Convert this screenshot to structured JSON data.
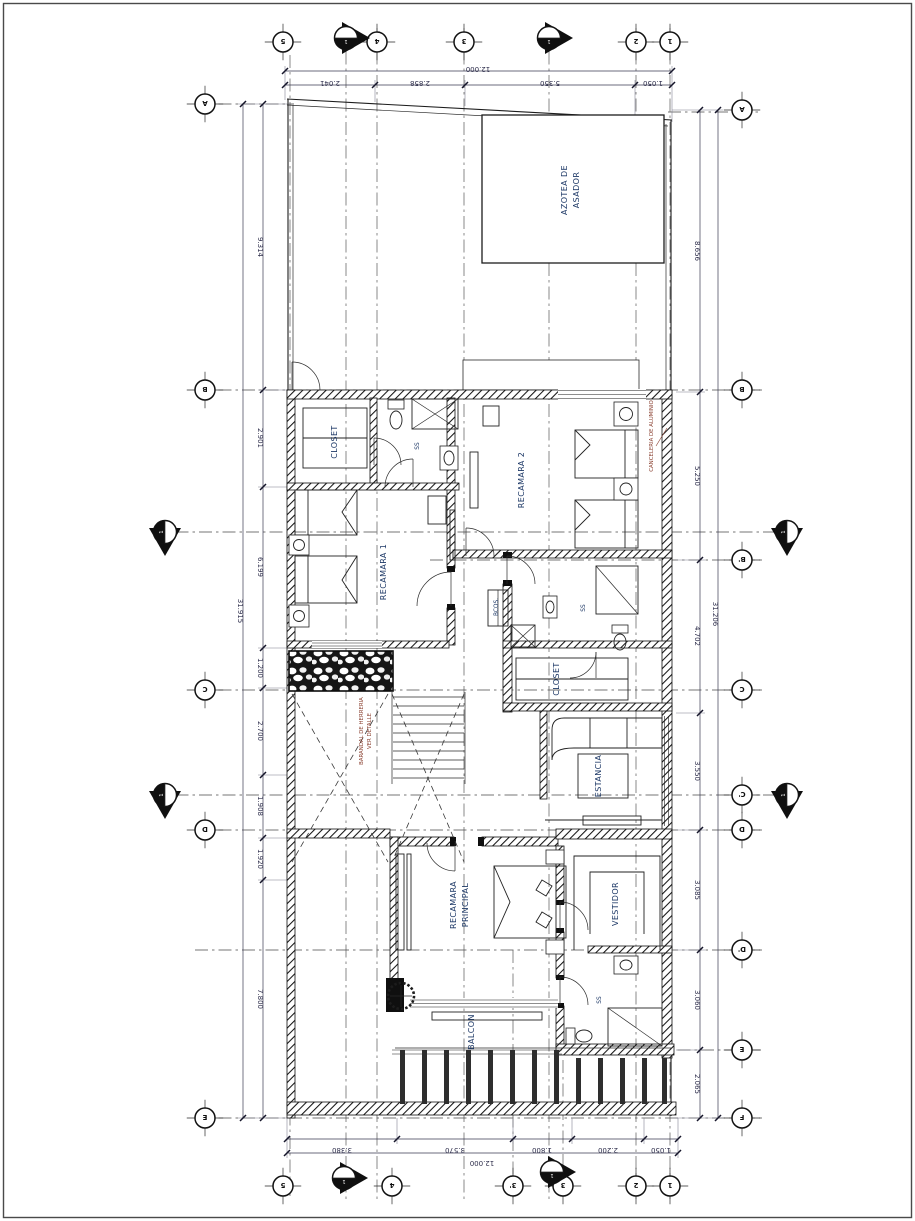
{
  "page": {
    "type_note": "architectural floor plan sheet (planta alta), rotated on page",
    "line_color": "#1c1c1c",
    "label_color": "#1d3866",
    "annotation_color": "#8a4030",
    "background": "#ffffff"
  },
  "rooms": {
    "azotea_line1": "AZOTEA DE",
    "azotea_line2": "ASADOR",
    "recamara2": "RECAMARA 2",
    "closet_recamara1": "CLOSET",
    "bath_top": "SS",
    "recamara1": "RECAMARA 1",
    "bcos": "BCOS.",
    "bath_mid": "SS",
    "closet_mid": "CLOSET",
    "estancia": "ESTANCIA",
    "recamara_principal_line1": "RECAMARA",
    "recamara_principal_line2": "PRINCIPAL",
    "vestidor": "VESTIDOR",
    "bath_principal": "SS",
    "balcon": "BALCON"
  },
  "annotations": {
    "stair_note_line1": "BARANDAL DE HERRERIA",
    "stair_note_line2": "VER DETALLE",
    "window_note": "CANCELERIA DE ALUMINIO"
  },
  "dimensions": {
    "top": {
      "total": "12.000",
      "segments": [
        "2.041",
        "2.858",
        "5.350",
        "1.050"
      ]
    },
    "bottom": {
      "total": "12.000",
      "segments": [
        "3.380",
        "3.570",
        "1.800",
        "2.200",
        "1.050"
      ]
    },
    "left": {
      "total": "31.915",
      "segments": [
        "9.314",
        "2.901",
        "6.199",
        "1.200",
        "2.700",
        "1.908",
        "1.920",
        "7.800"
      ]
    },
    "right": {
      "total": "31.206",
      "segments": [
        "8.656",
        "5.250",
        "4.702",
        "3.550",
        "3.085",
        "3.060",
        "2.065"
      ]
    }
  },
  "grid": {
    "top": [
      "5",
      "4",
      "3",
      "2",
      "1"
    ],
    "bottom": [
      "5",
      "4",
      "3'",
      "3",
      "2",
      "1"
    ],
    "left": [
      "A",
      "B",
      "C",
      "D",
      "E"
    ],
    "right": [
      "A",
      "B",
      "B'",
      "C",
      "C'",
      "D",
      "D'",
      "E",
      "F"
    ]
  },
  "section_marker": {
    "top_text": "T-01",
    "bottom_text": "1"
  }
}
